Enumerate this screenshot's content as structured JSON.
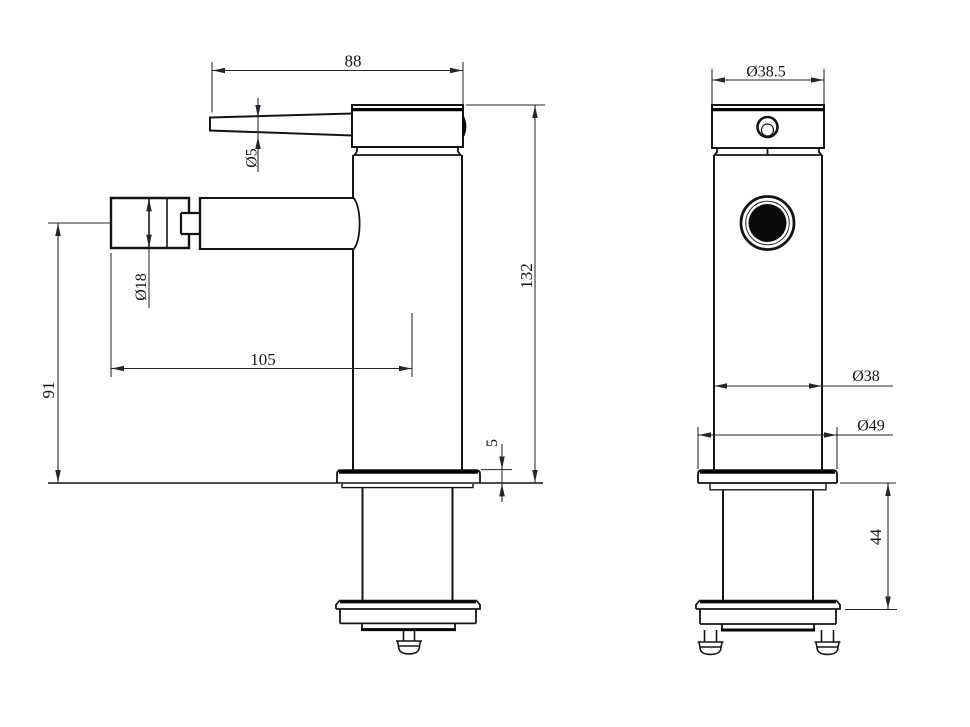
{
  "page": {
    "background": "#ffffff",
    "ink": "#141414"
  },
  "views": {
    "side": {
      "dims": {
        "lever_length": "88",
        "lever_thickness": "Ø5",
        "aerator_diameter": "Ø18",
        "spout_reach": "105",
        "spout_center_height": "91",
        "overall_height": "132",
        "base_plate_thickness": "5"
      }
    },
    "front": {
      "dims": {
        "head_diameter": "Ø38.5",
        "body_diameter": "Ø38",
        "base_plate_diameter": "Ø49",
        "mounting_depth": "44"
      }
    }
  }
}
